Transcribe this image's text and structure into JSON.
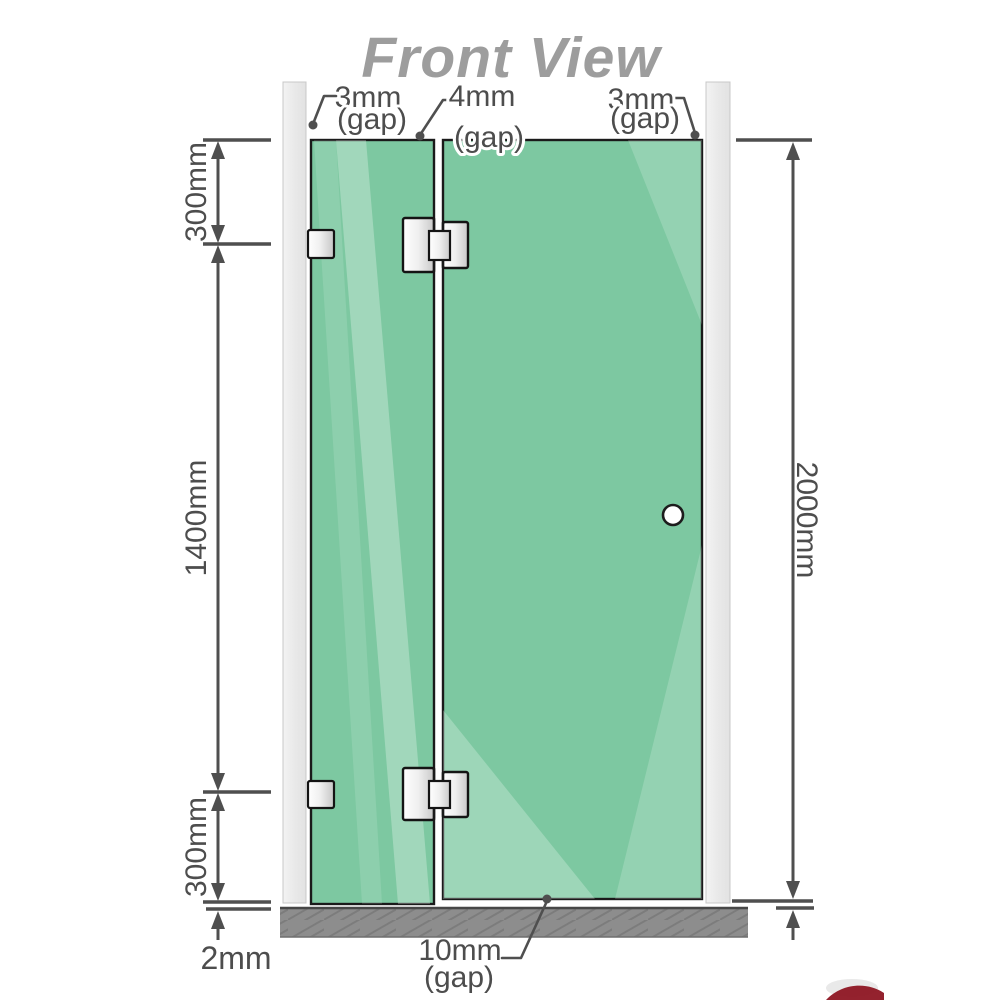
{
  "title": "Front View",
  "view": "shower screen front elevation drawing",
  "dims": {
    "gap_top_left": {
      "value": "3mm",
      "qualifier": "(gap)"
    },
    "gap_top_middle": {
      "value": "4mm",
      "qualifier": "(gap)"
    },
    "gap_top_right": {
      "value": "3mm",
      "qualifier": "(gap)"
    },
    "left_upper": "300mm",
    "left_middle": "1400mm",
    "left_lower": "300mm",
    "bottom_floor_gap": "2mm",
    "right_overall": "2000mm",
    "gap_bottom": {
      "value": "10mm",
      "qualifier": "(gap)"
    }
  },
  "colors": {
    "glass": "#7dc8a1",
    "glass_highlight": "#aadcc2",
    "wall_channel": "#e9e9e9",
    "floor": "#8d8d8d",
    "dimension": "#4f4f4f",
    "title_text": "#9d9d9d",
    "hardware": "#f2f2f2",
    "logo_accent": "#8e1623"
  }
}
